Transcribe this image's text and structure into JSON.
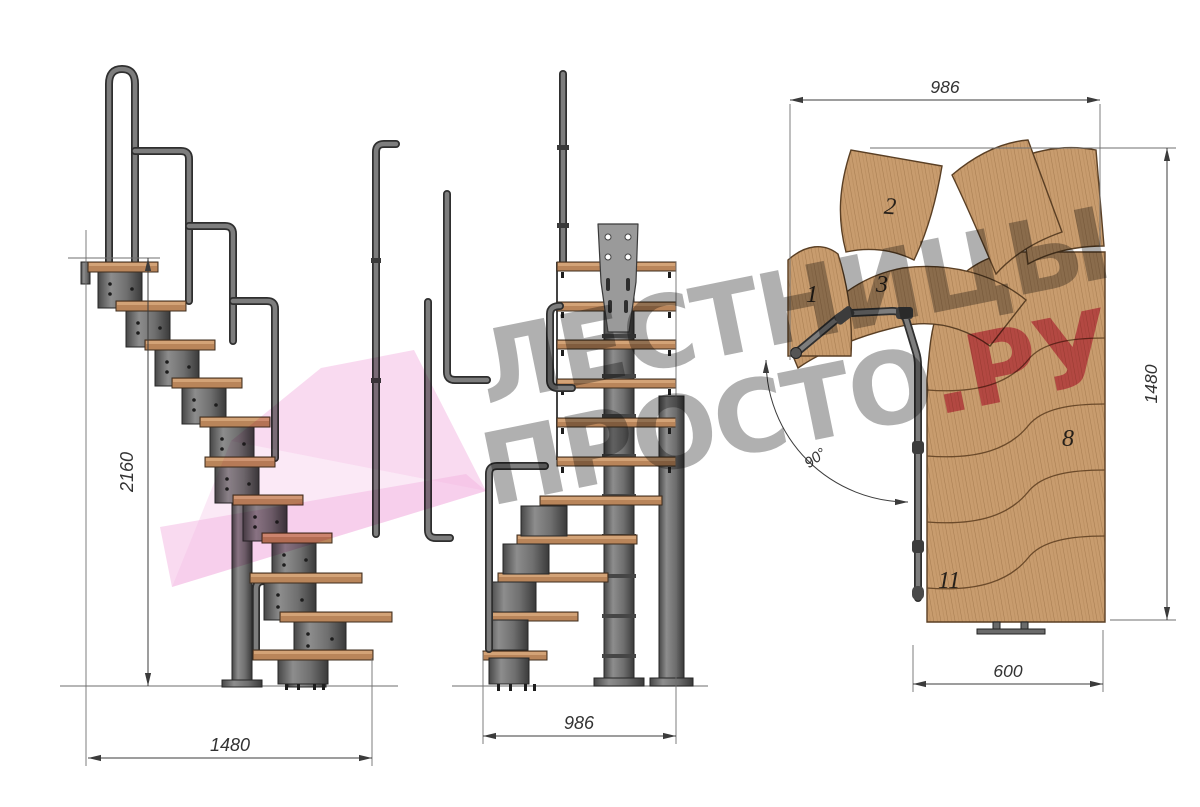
{
  "drawing": {
    "side_view": {
      "height_mm": "2160",
      "width_mm": "1480"
    },
    "front_view": {
      "width_mm": "986"
    },
    "plan_view": {
      "top_width_mm": "986",
      "right_depth_mm": "1480",
      "bottom_width_mm": "600",
      "turn_angle": "90°",
      "step_numbers": {
        "n1": "1",
        "n2": "2",
        "n3": "3",
        "n8": "8",
        "n11": "11"
      }
    }
  },
  "watermark": {
    "line1": "ЛЕСТНИЦЫ",
    "line2_gray": "ПРОСТО",
    "line2_pink": ".РУ"
  },
  "colors": {
    "wood": "#c89c6e",
    "metal": "#747474",
    "dim_lines": "#3b3b3b",
    "watermark_gray": "#9a9a9a",
    "watermark_pink": "#de4f7c",
    "arrow_pink": "#f3b5e2"
  }
}
